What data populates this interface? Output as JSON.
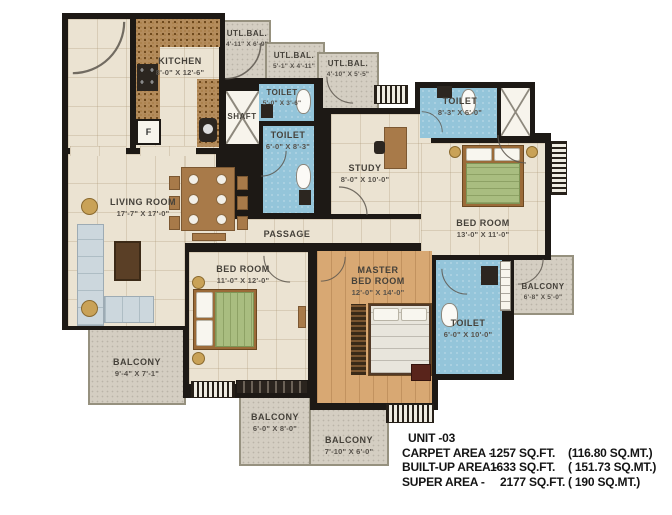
{
  "unit_info": {
    "unit": "UNIT -03",
    "areas": [
      {
        "label": "CARPET AREA -",
        "value": "1257 SQ.FT.",
        "metric": "(116.80 SQ.MT.)"
      },
      {
        "label": "BUILT-UP AREA -",
        "value": "1633 SQ.FT.",
        "metric": "( 151.73 SQ.MT.)"
      },
      {
        "label": "SUPER AREA -",
        "value": "2177 SQ.FT.",
        "metric": "( 190 SQ.MT.)"
      }
    ]
  },
  "rooms": {
    "kitchen": {
      "name": "KITCHEN",
      "dims": "8'-0\" X 12'-6\""
    },
    "utl_bal_1": {
      "name": "UTL.BAL.",
      "dims": "4'-11\" X 6'-9\""
    },
    "utl_bal_2": {
      "name": "UTL.BAL.",
      "dims": "5'-1\" X 4'-11\""
    },
    "utl_bal_3": {
      "name": "UTL.BAL.",
      "dims": "4'-10\" X 5'-5\""
    },
    "toilet_top": {
      "name": "TOILET",
      "dims": "5'-0\" X 3'-6\""
    },
    "toilet_mid": {
      "name": "TOILET",
      "dims": "6'-0\" X 8'-3\""
    },
    "shaft": {
      "name": "SHAFT"
    },
    "study": {
      "name": "STUDY",
      "dims": "8'-0\" X 10'-0\""
    },
    "toilet_right": {
      "name": "TOILET",
      "dims": "8'-3\" X 6'-0\""
    },
    "bedroom_right": {
      "name": "BED ROOM",
      "dims": "13'-0\" X 11'-0\""
    },
    "living_room": {
      "name": "LIVING ROOM",
      "dims": "17'-7\" X 17'-0\""
    },
    "passage": {
      "name": "PASSAGE"
    },
    "bedroom_mid": {
      "name": "BED ROOM",
      "dims": "11'-0\" X 12'-0\""
    },
    "master_bedroom": {
      "line1": "MASTER",
      "line2": "BED ROOM",
      "dims": "12'-0\" X 14'-0\""
    },
    "toilet_master": {
      "name": "TOILET",
      "dims": "6'-0\" X 10'-0\""
    },
    "balcony_left": {
      "name": "BALCONY",
      "dims": "9'-4\" X 7'-1\""
    },
    "balcony_right": {
      "name": "BALCONY",
      "dims": "6'-8\" X 5'-0\""
    },
    "balcony_bottom_1": {
      "name": "BALCONY",
      "dims": "6'-0\" X 8'-0\""
    },
    "balcony_bottom_2": {
      "name": "BALCONY",
      "dims": "7'-10\" X 6'-0\""
    }
  },
  "fixtures": {
    "fridge_label": "F"
  },
  "colors": {
    "wall": "#1d1915",
    "floor_tile": "#ebe3d2",
    "toilet_blue": "#94c5da",
    "master_wood": "#d8a873",
    "balcony_gray": "#d4cec2",
    "counter_brown": "#b48c5c",
    "duvet_green": "#a9bd80"
  }
}
